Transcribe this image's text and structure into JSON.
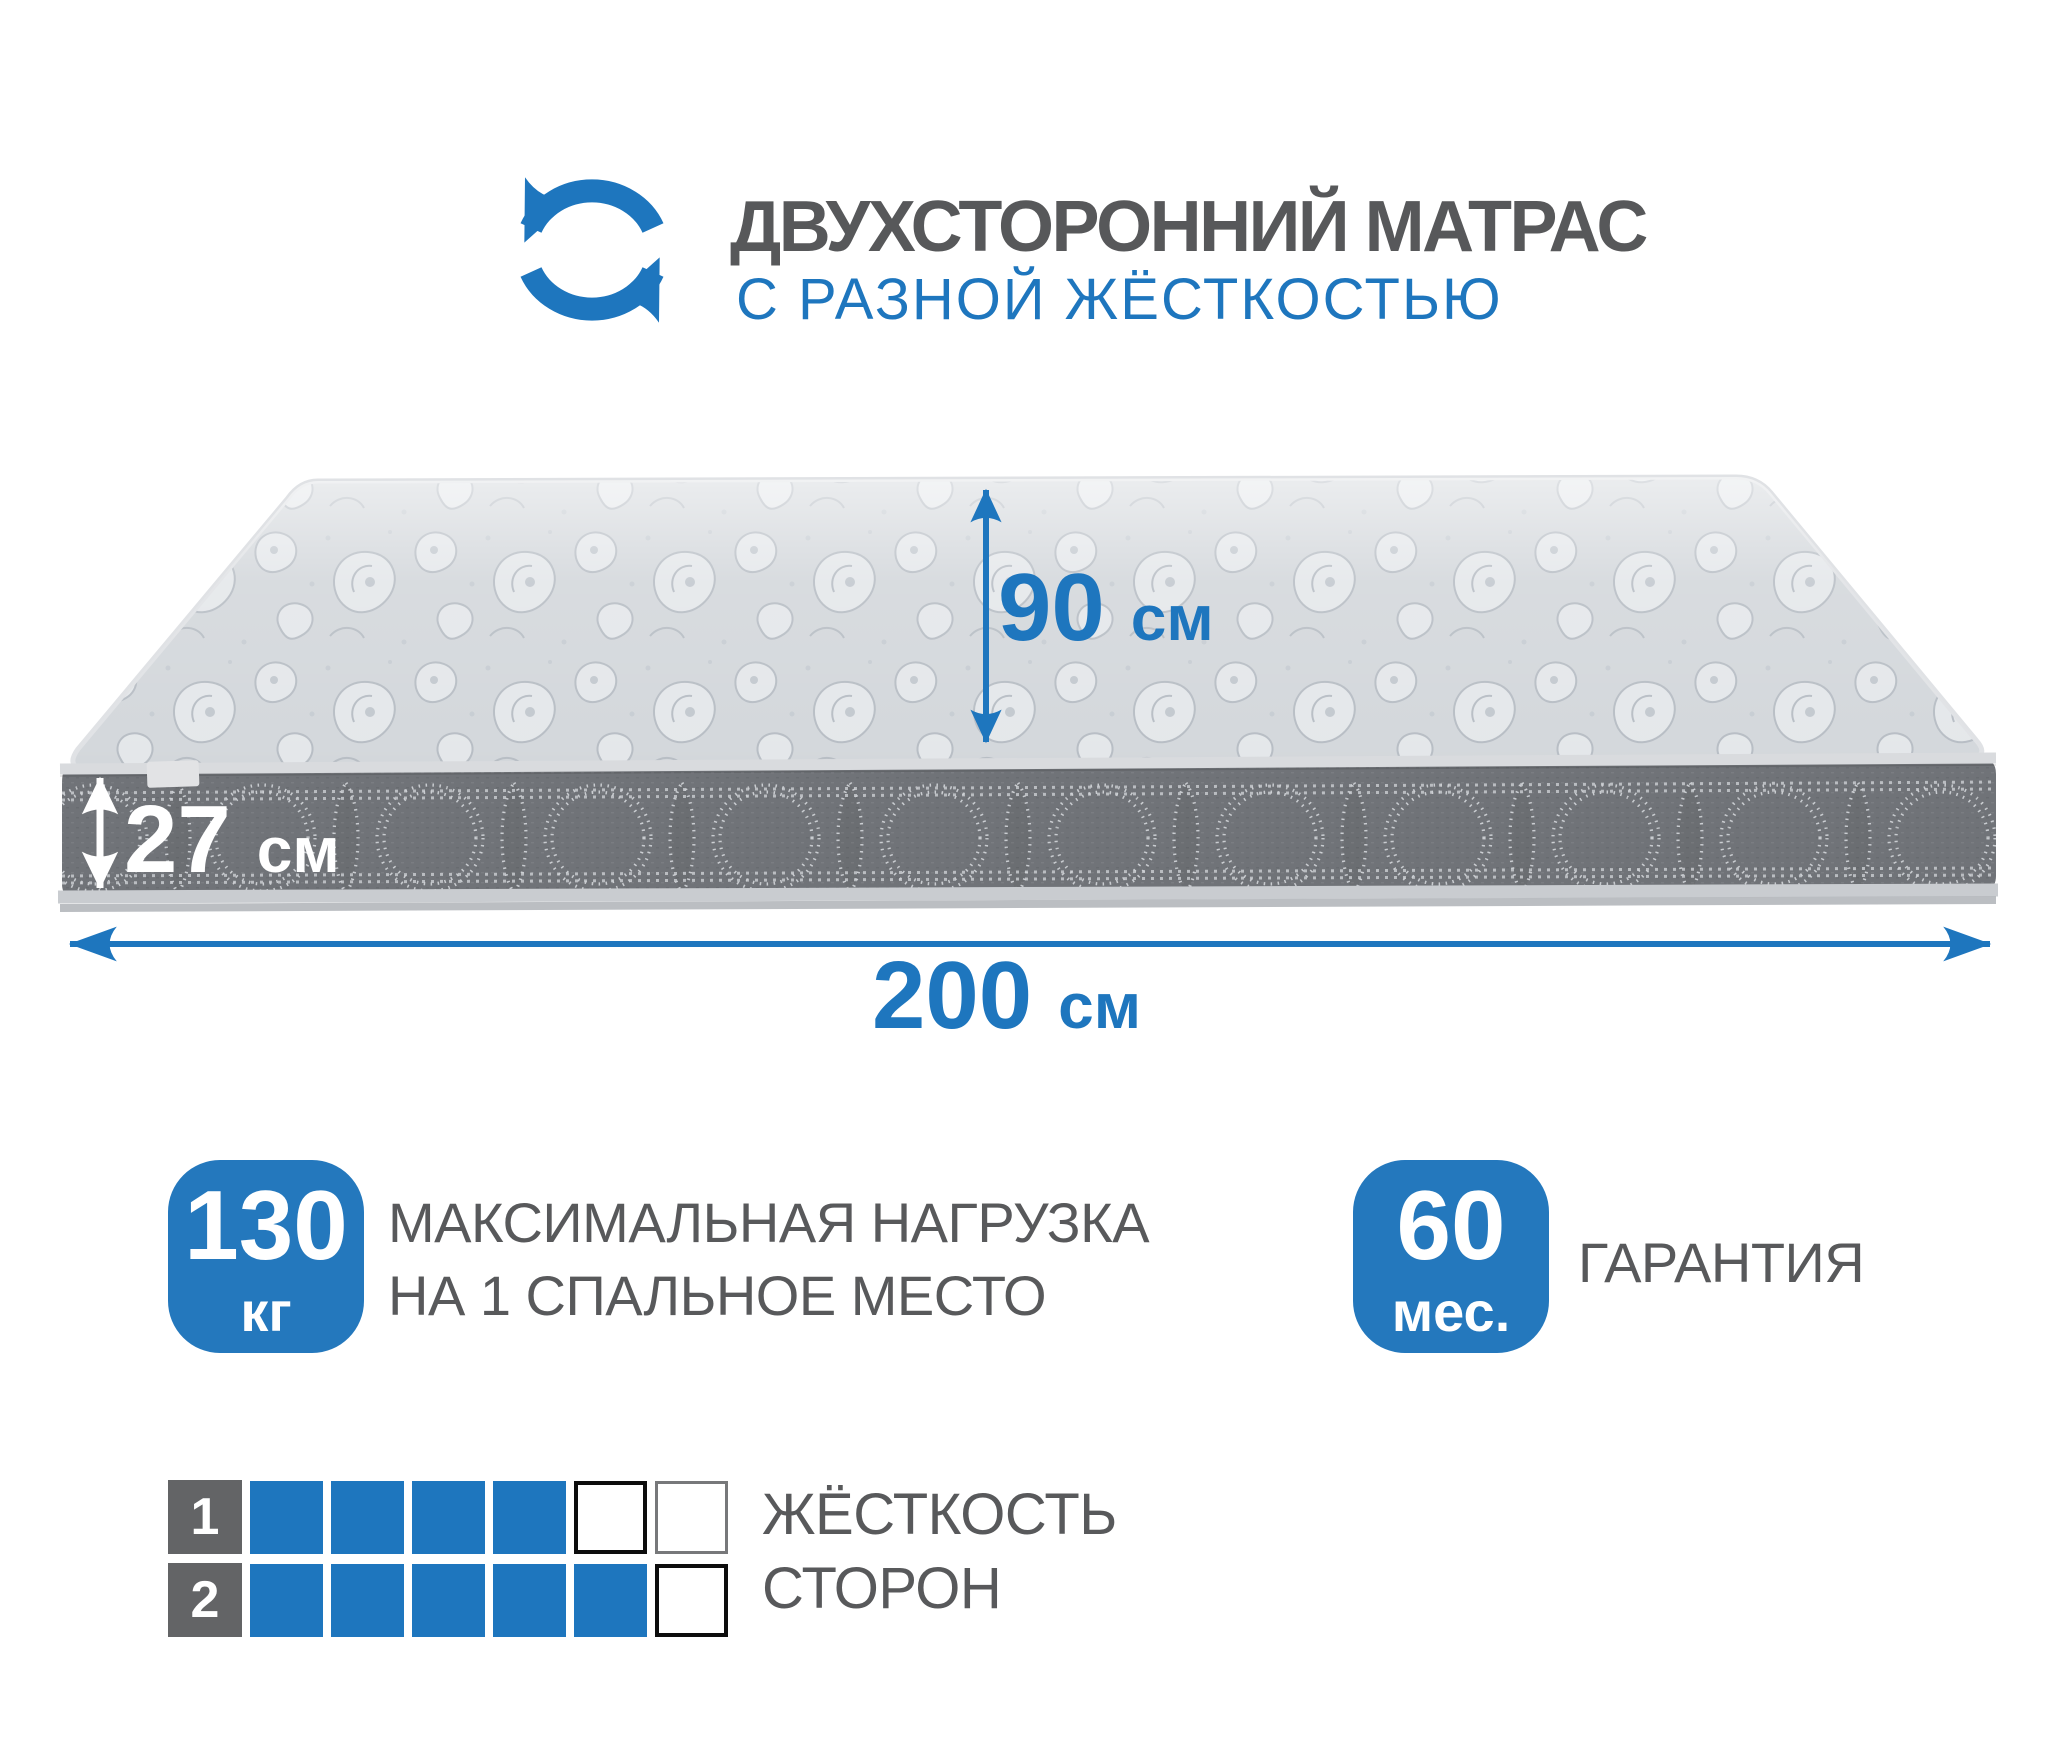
{
  "colors": {
    "accent": "#1e76be",
    "badge": "#2478bd",
    "title_text": "#57585a",
    "body_text": "#58595b",
    "label_square": "#636466",
    "top_base": "#d3d7db",
    "band_base": "#707378",
    "piping": "#d9dbde",
    "stitch": "#d3d6da"
  },
  "header": {
    "icon": "rotate-arrows-icon",
    "title": "ДВУХСТОРОННИЙ МАТРАС",
    "subtitle": "С РАЗНОЙ ЖЁСТКОСТЬЮ"
  },
  "mattress": {
    "height": {
      "value": "90",
      "unit": "см"
    },
    "thickness": {
      "value": "27",
      "unit": "см"
    },
    "length": {
      "value": "200",
      "unit": "см"
    }
  },
  "badges": {
    "load": {
      "value": "130",
      "unit": "кг",
      "line1": "МАКСИМАЛЬНАЯ НАГРУЗКА",
      "line2": "НА 1 СПАЛЬНОЕ МЕСТО"
    },
    "warranty": {
      "value": "60",
      "unit": "мес.",
      "label": "ГАРАНТИЯ"
    }
  },
  "firmness": {
    "caption_line1": "ЖЁСТКОСТЬ",
    "caption_line2": "СТОРОН",
    "rows": [
      {
        "label": "1",
        "cells": [
          "filled",
          "filled",
          "filled",
          "filled",
          "empty-dark",
          "empty-light"
        ]
      },
      {
        "label": "2",
        "cells": [
          "filled",
          "filled",
          "filled",
          "filled",
          "filled",
          "empty-dark"
        ]
      }
    ]
  }
}
